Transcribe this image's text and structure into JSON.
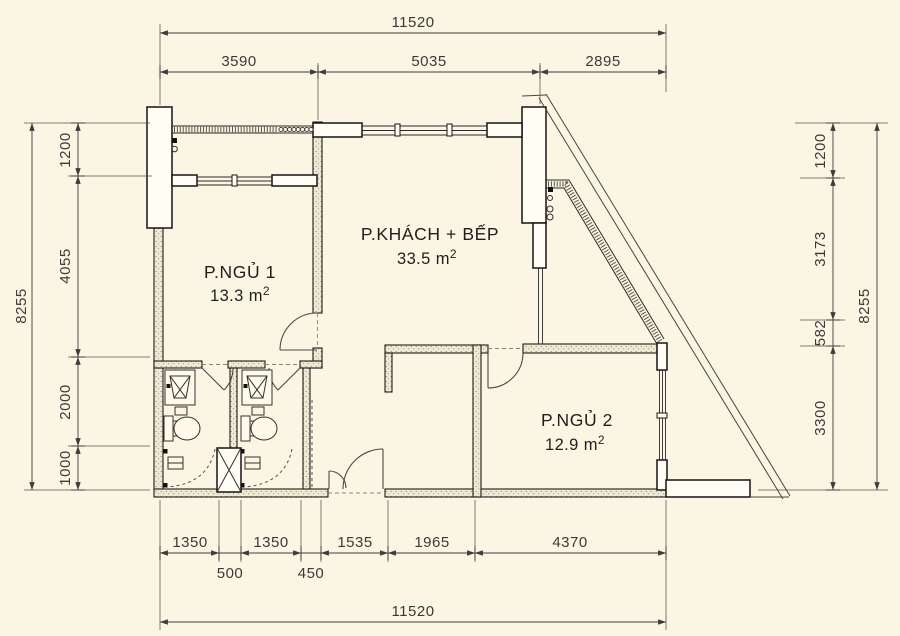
{
  "colors": {
    "background": "#fbf6e3",
    "wall_line": "#1c1c1c",
    "dim_line": "#3c3c3c",
    "label_text": "#1f1f1f"
  },
  "plan": {
    "rooms": [
      {
        "name": "P.NGỦ 1",
        "area": "13.3 m",
        "area_sup": "2"
      },
      {
        "name": "P.KHÁCH + BẾP",
        "area": "33.5 m",
        "area_sup": "2"
      },
      {
        "name": "P.NGỦ 2",
        "area": "12.9 m",
        "area_sup": "2"
      }
    ]
  },
  "dims": {
    "top": {
      "total": "11520",
      "chain": [
        "3590",
        "5035",
        "2895"
      ]
    },
    "bottom": {
      "total": "11520",
      "chain": [
        "1350",
        "1350",
        "1535",
        "1965",
        "4370"
      ],
      "sub": [
        "500",
        "450"
      ]
    },
    "left": {
      "total": "8255",
      "chain": [
        "1200",
        "4055",
        "2000",
        "1000"
      ]
    },
    "right": {
      "total": "8255",
      "chain": [
        "1200",
        "3173",
        "582",
        "3300"
      ]
    }
  }
}
